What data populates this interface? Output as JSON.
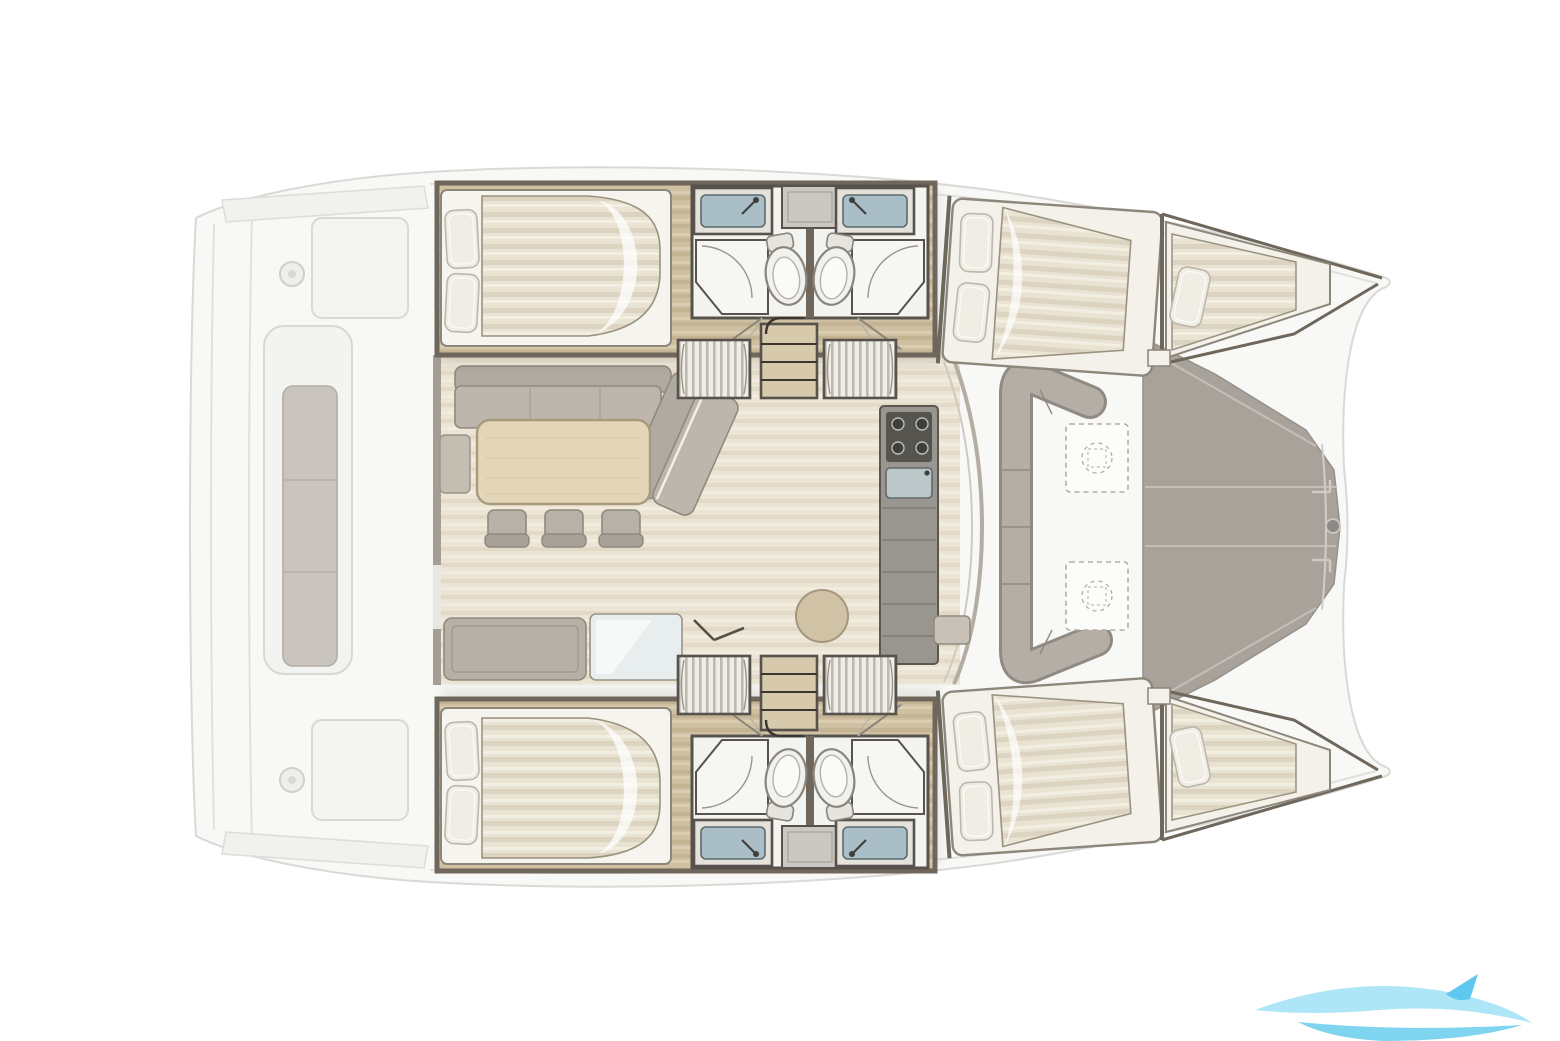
{
  "scene": {
    "type": "yacht-floor-plan",
    "vessel": "catamaran",
    "view": "top-down accommodation / deck plan",
    "bow_direction": "right"
  },
  "palette": {
    "background": "#ffffff",
    "ghost_deck": "#f8f8f6",
    "ghost_line": "#d9d9d6",
    "ghost_furniture": "#f1f1ee",
    "cushion_gray": "#c9c4bd",
    "wall": "#6f675c",
    "wall_dark": "#57524b",
    "wood_hull": "#cfc0a2",
    "wood_hull_shade": "#c4b494",
    "wood_hull_light": "#dacdb2",
    "wood_saloon": "#ece5d5",
    "wood_saloon_shade": "#e2dac7",
    "wood_saloon_light": "#f2ecdf",
    "bed_linen": "#e9e3d3",
    "bed_linen_shade": "#dcd4c0",
    "bed_linen_light": "#f2eee2",
    "pillow": "#f0ede4",
    "upholstery": "#bcb6ac",
    "upholstery_dark": "#b0aaa1",
    "table_wood": "#e3d6b8",
    "foredeck": "#a9a29b",
    "fixture_white": "#f3f3f0",
    "sink_basin": "#a9bec7",
    "stove_dark": "#55544f",
    "counter_gray": "#999690",
    "watermark_light": "#aee6f8",
    "watermark_mid": "#7fd4f0"
  },
  "regions": {
    "aft_cockpit": {
      "items": [
        "swim-steps",
        "cockpit-bench",
        "winches",
        "cockpit-tables"
      ]
    },
    "port_hull": {
      "items": [
        "aft-double-cabin",
        "bathroom-twin-sinks-toilets-showers",
        "wardrobes",
        "companionway-stairs",
        "forward-double-cabin",
        "forepeak-berth"
      ]
    },
    "starboard_hull": {
      "items": [
        "aft-double-cabin",
        "bathroom-twin-sinks-toilets-showers",
        "wardrobes",
        "companionway-stairs",
        "forward-double-cabin",
        "forepeak-berth"
      ]
    },
    "saloon": {
      "items": [
        "l-shaped-sofa",
        "dining-table",
        "three-chairs",
        "aft-bench",
        "chart-table",
        "galley-stove-sink-counter",
        "pouf"
      ]
    },
    "forward_cockpit": {
      "items": [
        "u-shaped-bench",
        "two-folding-tables"
      ]
    },
    "foredeck": {
      "items": [
        "solid-deck-panels",
        "bridle-fitting"
      ]
    }
  },
  "watermark": {
    "shape": "wave-swoosh",
    "position": "bottom-right"
  }
}
